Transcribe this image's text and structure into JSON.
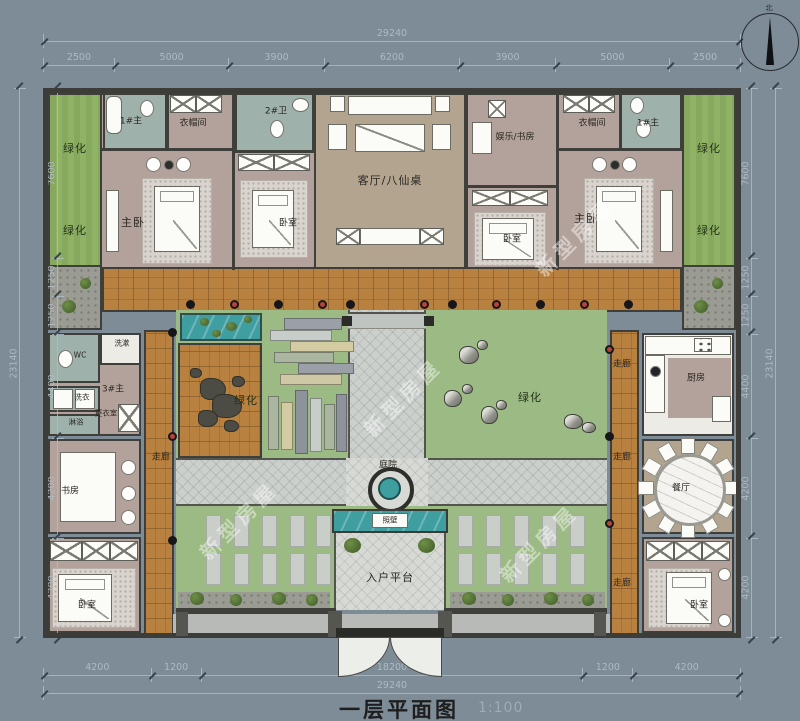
{
  "title": {
    "main": "一层平面图",
    "scale": "1:100"
  },
  "compass": {
    "north": "北"
  },
  "watermark": {
    "text": "新型房屋"
  },
  "dims": {
    "top_total": "29240",
    "top_segments": [
      2500,
      5000,
      3900,
      6200,
      3900,
      5000,
      2500
    ],
    "bottom_segments": [
      4200,
      1200,
      18200,
      1200,
      4200
    ],
    "bottom_total": "29240",
    "left_total": "23140",
    "left_segments": [
      7600,
      1250,
      1250,
      4400,
      4200,
      4200
    ],
    "right_segments": [
      7600,
      1250,
      1250,
      4400,
      4200,
      4200
    ],
    "right_total": "23140"
  },
  "rooms": {
    "green": "绿化",
    "master": "主卧",
    "bedroom": "卧室",
    "living": "客厅/八仙桌",
    "ent_study": "娱乐/书房",
    "cloak": "衣帽间",
    "bath1": "1#主",
    "bath2": "2#卫",
    "suite3": "3#主",
    "wc": "WC",
    "wash": "洗漱",
    "laundry": "洗衣",
    "shower": "淋浴",
    "dressing": "更衣室",
    "study": "书房",
    "corridor": "走廊",
    "kitchen": "厨房",
    "dining": "餐厅",
    "courtyard": "庭院",
    "screen_wall": "照壁",
    "entry_platform": "入户平台"
  },
  "colors": {
    "background": "#7E8C98",
    "wall": "#3E3E3A",
    "bedroom_floor": "#B3A29B",
    "living_floor": "#B2A48F",
    "bath_floor": "#9FB1AB",
    "green": "#8FB265",
    "grass": "#9CBA84",
    "wood": "#B9813F",
    "stone": "#CBD0CC",
    "water": "#3F9EA0"
  }
}
